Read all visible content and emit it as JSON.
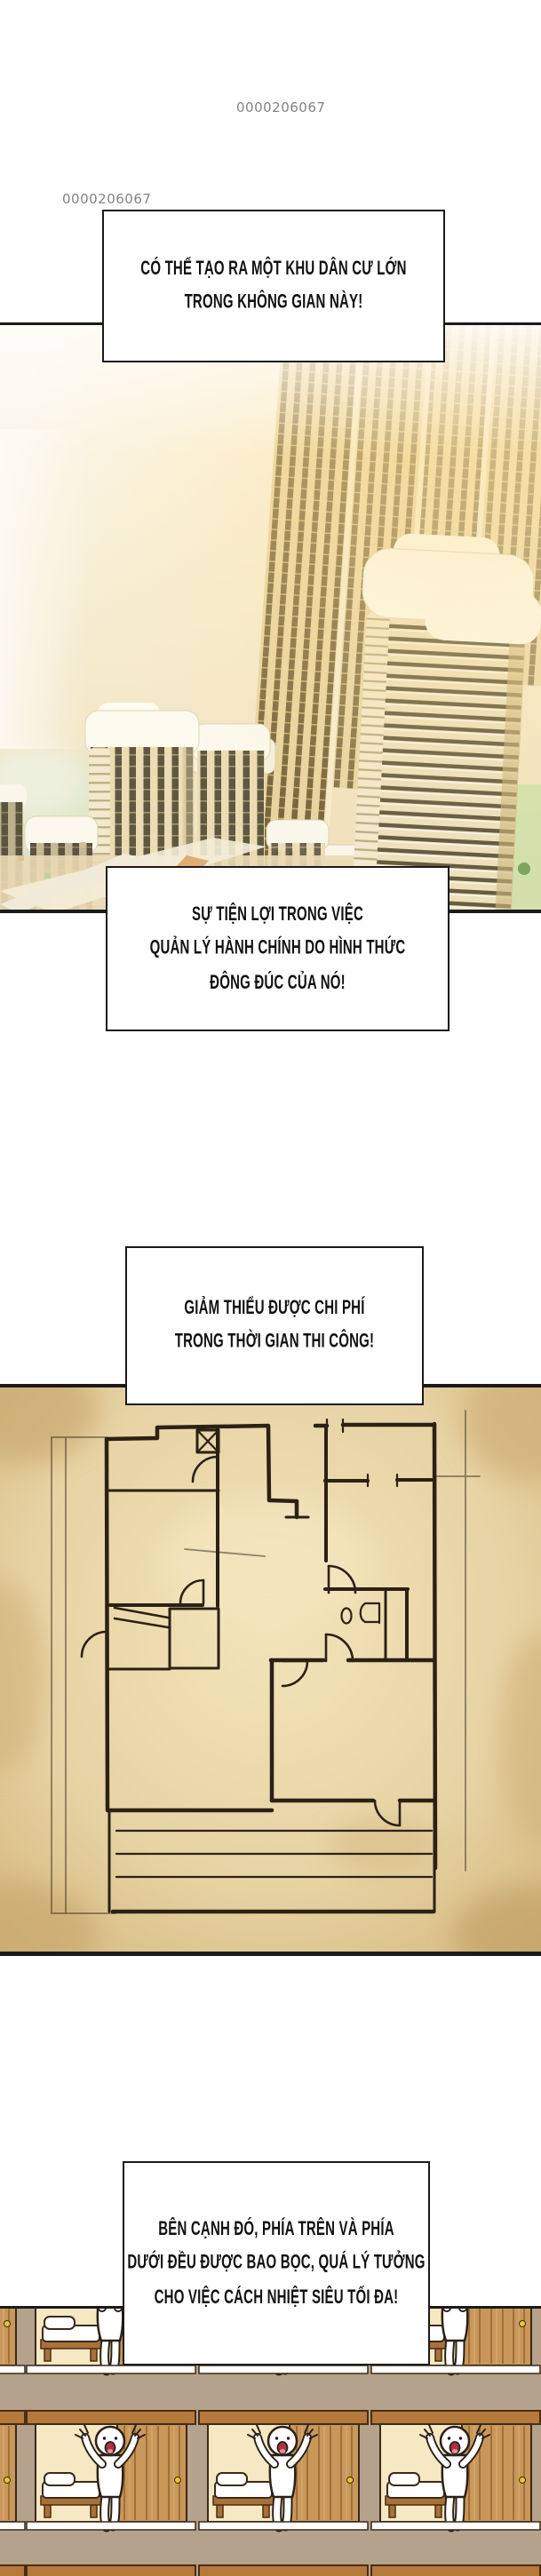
{
  "page": {
    "code_top": "0000206067",
    "code_left": "0000206067"
  },
  "bubbles": [
    {
      "id": "bubble-1",
      "text": "CÓ THỂ TẠO RA MỘT KHU DÂN CƯ LỚN\nTRONG KHÔNG GIAN NÀY!"
    },
    {
      "id": "bubble-2",
      "text": "SỰ TIỆN LỢI TRONG VIỆC\nQUẢN LÝ HÀNH CHÍNH DO HÌNH THỨC\nĐÔNG ĐÚC CỦA NÓ!"
    },
    {
      "id": "bubble-3",
      "text": "GIẢM THIỂU ĐƯỢC CHI PHÍ\nTRONG THỜI GIAN THI CÔNG!"
    },
    {
      "id": "bubble-4",
      "text": "BÊN CẠNH ĐÓ, PHÍA TRÊN VÀ PHÍA\nDƯỚI ĐỀU ĐƯỢC BAO BỌC, QUÁ LÝ TƯỞNG\nCHO VIỆC CÁCH NHIỆT SIÊU TỐI ĐA!"
    }
  ],
  "panels": [
    {
      "name": "city-towers",
      "description": "Aerial view of a dense high-rise apartment complex in warm golden light"
    },
    {
      "name": "floor-plan",
      "description": "Hand-drawn apartment floor plan sketched on aged parchment"
    },
    {
      "name": "capsule-rooms",
      "description": "Grid of identical compact rooms, each with a bed, wooden sliding door and a cheering white figure"
    }
  ],
  "palette": {
    "ink": "#1a1a1a",
    "page-code-gray": "#838383",
    "bubble-bg": "#ffffff",
    "parchment": "#e7d3a4",
    "plan-ink": "#2b2115",
    "wall-taupe": "#b5a28c",
    "room-cream": "#f6e8c2",
    "wood": "#c9975a",
    "wood-dark": "#8a5a28",
    "mouth-red": "#b03040"
  }
}
